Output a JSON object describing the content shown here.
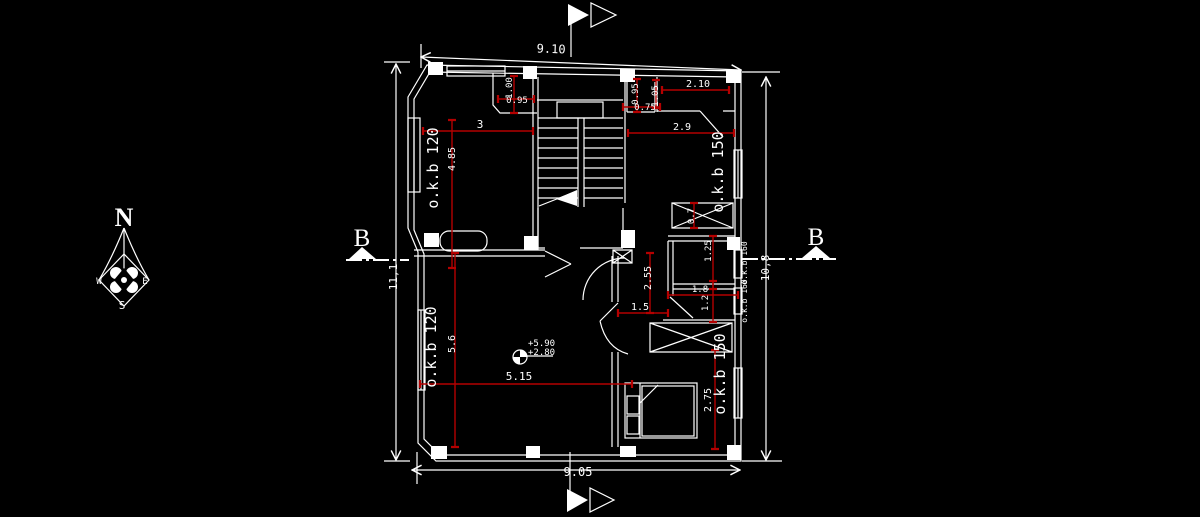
{
  "canvas": {
    "background": "#000000",
    "wall_color": "#ffffff",
    "dimension_color": "#b40000"
  },
  "compass": {
    "north": "N",
    "east": "E",
    "south": "S",
    "west": "W"
  },
  "section_markers": {
    "left": "B",
    "right": "B"
  },
  "overall_dimensions": {
    "top": "9.10",
    "bottom": "9.05",
    "left": "11,1",
    "right": "10,8"
  },
  "wall_labels": {
    "upper_left": "o.k.b 120",
    "lower_left": "o.k.b 120",
    "upper_right": "o.k.b 150",
    "lower_right": "o.k.b 150",
    "right_small_upper": "o.k.b 160",
    "right_small_lower": "o.k.b 160"
  },
  "dimensions": {
    "upper_room_width": "3",
    "upper_room_depth": "4.85",
    "alcove_depth": "1.00",
    "alcove_width": "0.95",
    "wc_depth": "0.95",
    "wc_width": "0.75",
    "top_right_depth": "1.05",
    "top_right_width": "2.10",
    "top_right_room_width": "2.9",
    "duct_depth": "0.7",
    "bath_depth": "1.25",
    "hall_depth": "2.55",
    "bath_width": "1.8",
    "bath_lower_depth": "1.2",
    "corridor_width": "1.5",
    "living_depth": "5.6",
    "living_width": "5.15",
    "bedroom_depth": "2.75"
  },
  "level_marker": {
    "upper_level": "+5.90",
    "lower_level": "+2.80"
  }
}
